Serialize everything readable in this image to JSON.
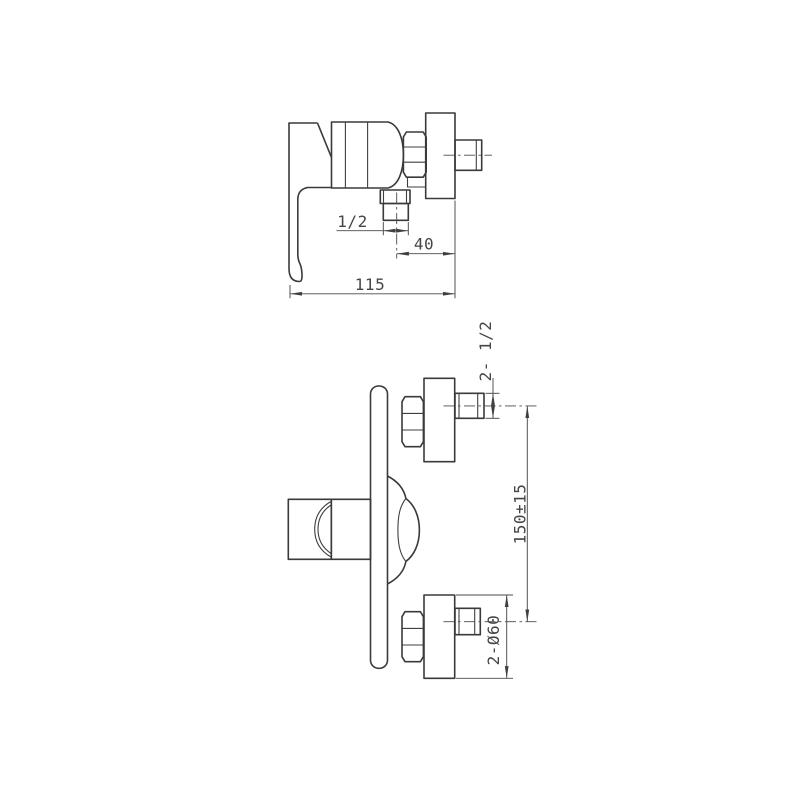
{
  "views": {
    "side_view": {
      "dims": {
        "outlet_thread": "1/2",
        "outlet_to_wall": "40",
        "depth": "115"
      }
    },
    "front_view": {
      "dims": {
        "inlet_thread": "2- 1/2",
        "inlet_spacing": "150±15",
        "flange_diameter": "2-Ø60"
      }
    }
  }
}
